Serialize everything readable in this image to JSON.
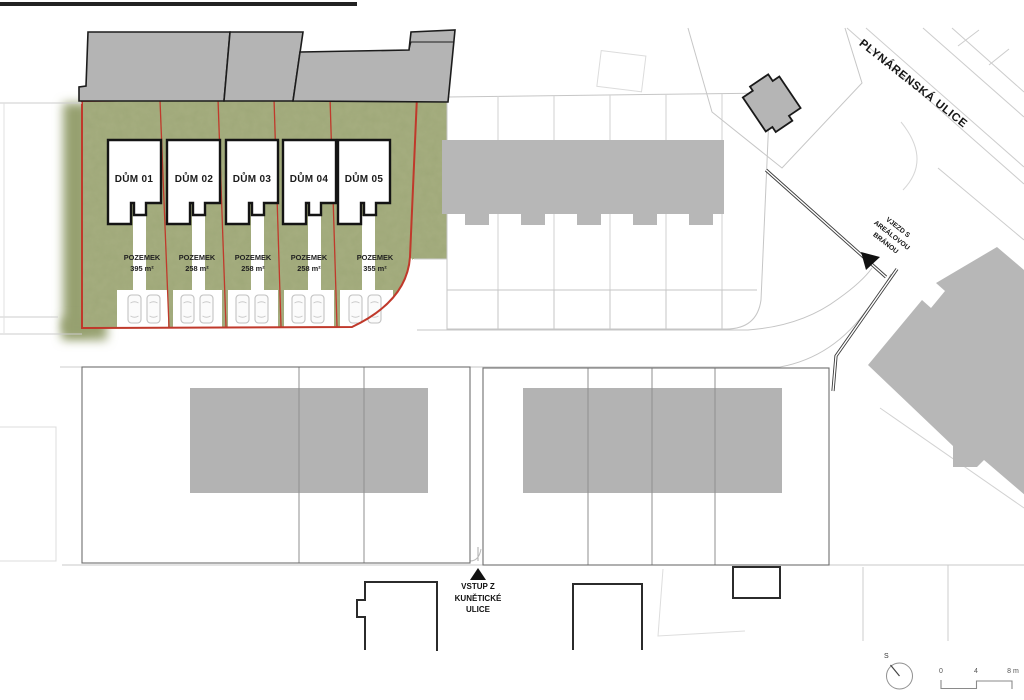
{
  "site": {
    "houses": [
      {
        "label": "DŮM 01",
        "plot_word": "POZEMEK",
        "area": "395 m²"
      },
      {
        "label": "DŮM 02",
        "plot_word": "POZEMEK",
        "area": "258 m²"
      },
      {
        "label": "DŮM 03",
        "plot_word": "POZEMEK",
        "area": "258 m²"
      },
      {
        "label": "DŮM 04",
        "plot_word": "POZEMEK",
        "area": "258 m²"
      },
      {
        "label": "DŮM 05",
        "plot_word": "POZEMEK",
        "area": "355 m²"
      }
    ]
  },
  "labels": {
    "street": "PLYNÁRENSKÁ ULICE",
    "gate_line1": "VJEZD S",
    "gate_line2": "AREÁLOVOU",
    "gate_line3": "BRÁNOU",
    "entrance_line1": "VSTUP Z",
    "entrance_line2": "KUNĚTICKÉ",
    "entrance_line3": "ULICE"
  },
  "scale_bar": {
    "tick0": "0",
    "tick1": "4",
    "tick2": "8 m"
  },
  "north": {
    "label": "S"
  },
  "colors": {
    "site_green": "#a6ae80",
    "boundary_red": "#c0392b",
    "building_grey": "#b5b5b5"
  }
}
